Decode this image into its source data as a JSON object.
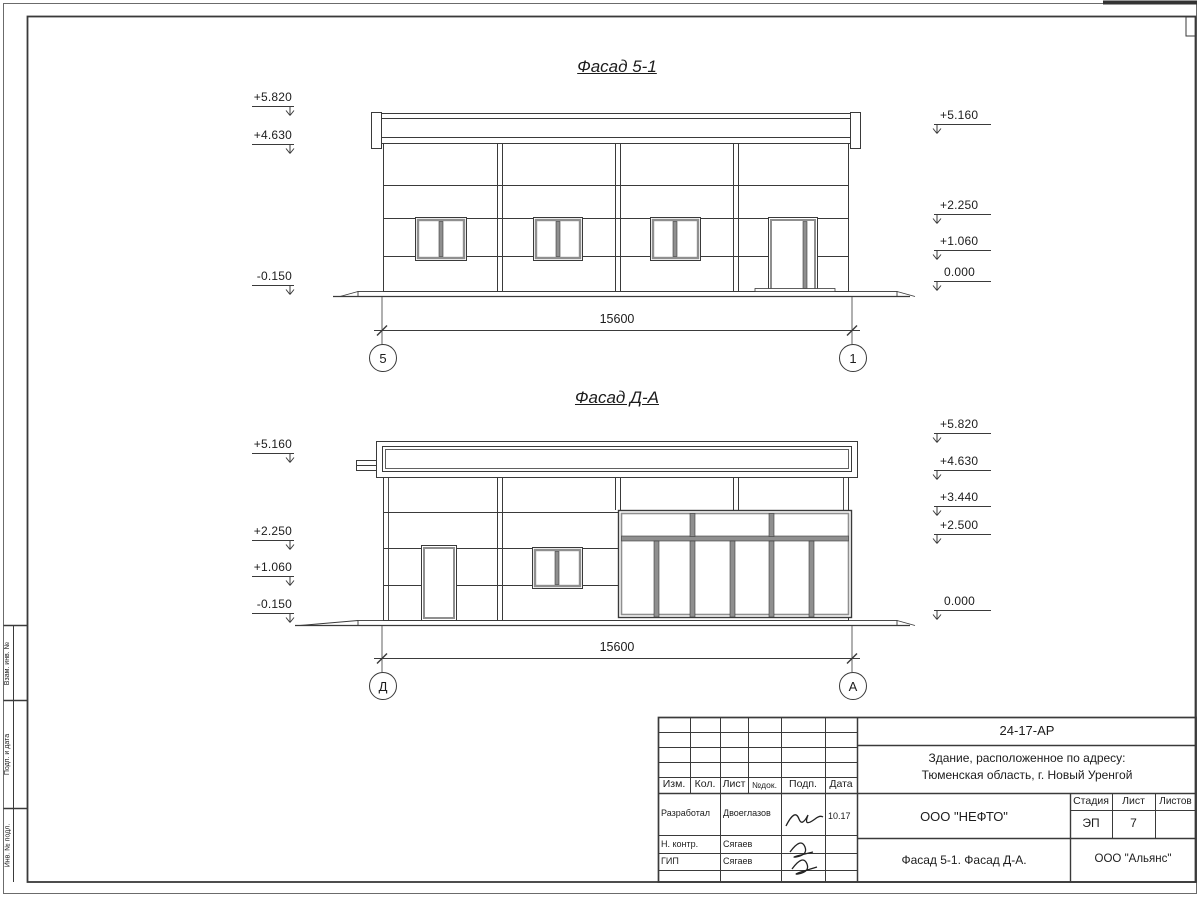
{
  "facades": [
    {
      "title": "Фасад 5-1",
      "dim": "15600",
      "axis_start": "5",
      "axis_end": "1",
      "marks_left": [
        "+5.820",
        "+4.630",
        "-0.150"
      ],
      "marks_right": [
        "+5.160",
        "+2.250",
        "+1.060",
        "0.000"
      ]
    },
    {
      "title": "Фасад Д-А",
      "dim": "15600",
      "axis_start": "Д",
      "axis_end": "А",
      "marks_left": [
        "+5.160",
        "+2.250",
        "+1.060",
        "-0.150"
      ],
      "marks_right": [
        "+5.820",
        "+4.630",
        "+3.440",
        "+2.500",
        "0.000"
      ]
    }
  ],
  "side_strip": {
    "labels": [
      "Взам. инв. №",
      "Подп. и дата",
      "Инв. № подл."
    ]
  },
  "title_block": {
    "doc_number": "24-17-АР",
    "address_line1": "Здание, расположенное по адресу:",
    "address_line2": "Тюменская область, г. Новый Уренгой",
    "col_izm": "Изм.",
    "col_kol": "Кол.",
    "col_list": "Лист",
    "col_ndok": "№док.",
    "col_podp": "Подп.",
    "col_data": "Дата",
    "row_developed_label": "Разработал",
    "row_developed_name": "Двоеглазов",
    "row_developed_date": "10.17",
    "row_ncontr_label": "Н. контр.",
    "row_ncontr_name": "Сягаев",
    "row_gip_label": "ГИП",
    "row_gip_name": "Сягаев",
    "company": "ООО \"НЕФТО\"",
    "stage_label": "Стадия",
    "sheet_label": "Лист",
    "sheets_label": "Листов",
    "stage_value": "ЭП",
    "sheet_value": "7",
    "sheets_value": "",
    "sheet_title": "Фасад 5-1. Фасад Д-А.",
    "contractor": "ООО \"Альянс\""
  },
  "colors": {
    "line": "#3a3a3a",
    "light_frame": "#8f8f8f",
    "paper": "#ffffff"
  }
}
